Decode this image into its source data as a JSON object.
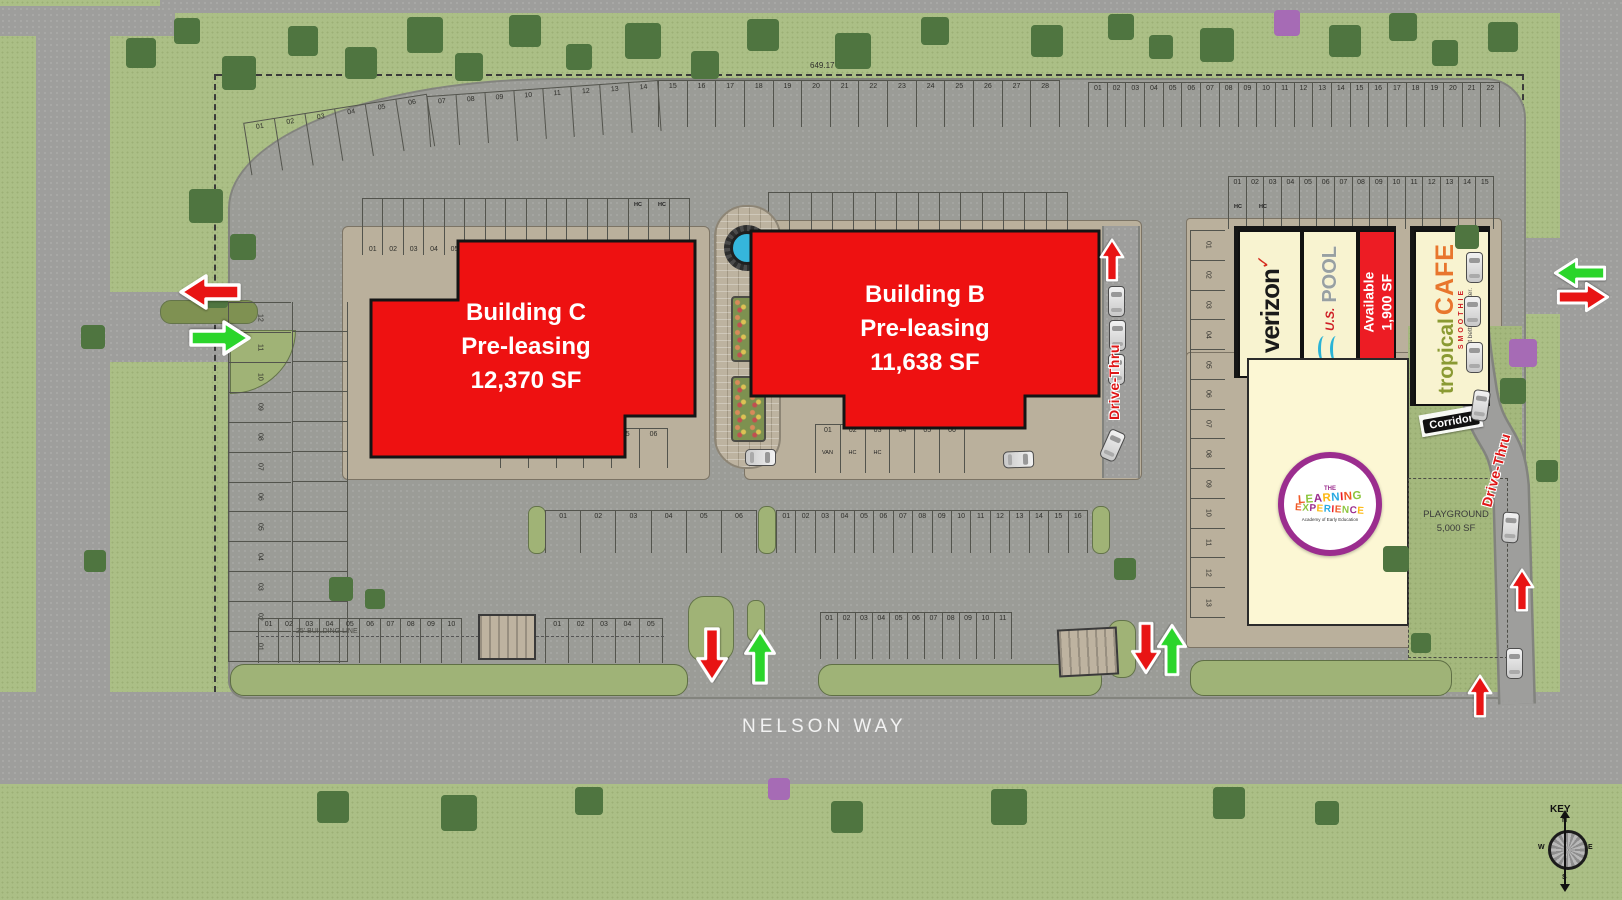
{
  "site": {
    "street_name": "NELSON WAY",
    "boundary_length": "649.17'",
    "boundary_bearing": "N 89°26'09\" E",
    "building_line": "25' BUILDING LINE",
    "key_label": "KEY",
    "compass": {
      "n": "N",
      "e": "E",
      "s": "S",
      "w": "W"
    }
  },
  "buildings": {
    "c": {
      "name": "Building C",
      "status": "Pre-leasing",
      "area": "12,370 SF"
    },
    "b": {
      "name": "Building B",
      "status": "Pre-leasing",
      "area": "11,638 SF"
    },
    "available": {
      "label": "Available",
      "area": "1,900 SF"
    }
  },
  "tenants": {
    "verizon": {
      "name": "verizon",
      "mark": "✓"
    },
    "us_pool": {
      "prefix": "U.S.",
      "name": "POOL"
    },
    "tropical": {
      "main": "tropical",
      "sub": "SMOOTHIE",
      "cafe": "CAFE",
      "tagline": "eat better. feel better."
    },
    "learning": {
      "the": "THE",
      "word1": "LEARNING",
      "word2": "EXPERIENCE",
      "tagline": "Academy of Early Education"
    }
  },
  "labels": {
    "drive_thru": "Drive-Thru",
    "corridor": "Corridor",
    "playground": "PLAYGROUND",
    "playground_area": "5,000 SF",
    "hc": "HC",
    "van": "VAN"
  },
  "parking": {
    "top_row_a": [
      "01",
      "02",
      "03",
      "04",
      "05",
      "06"
    ],
    "top_row_b": [
      "07",
      "08",
      "09",
      "10",
      "11",
      "12",
      "13",
      "14"
    ],
    "top_row_c": [
      "15",
      "16",
      "17",
      "18",
      "19",
      "20",
      "21",
      "22",
      "23",
      "24",
      "25",
      "26",
      "27",
      "28"
    ],
    "top_right_row": [
      "01",
      "02",
      "03",
      "04",
      "05",
      "06",
      "07",
      "08",
      "09",
      "10",
      "11",
      "12",
      "13",
      "14",
      "15",
      "16",
      "17",
      "18",
      "19",
      "20",
      "21",
      "22"
    ],
    "row_above_c": [
      "01",
      "02",
      "03",
      "04",
      "05",
      "06",
      "07",
      "08",
      "09",
      "10",
      "11",
      "12",
      "13",
      "14",
      "15",
      "16"
    ],
    "row_above_b": [
      "01",
      "02",
      "03",
      "04",
      "05",
      "06",
      "07",
      "08",
      "09",
      "10",
      "11",
      "12",
      "13",
      "14"
    ],
    "strip_front": [
      "01",
      "02",
      "03",
      "04",
      "05",
      "06",
      "07",
      "08",
      "09",
      "10",
      "11",
      "12",
      "13",
      "14",
      "15"
    ],
    "left_column": [
      "12",
      "11",
      "10",
      "09",
      "08",
      "07",
      "06",
      "05",
      "04",
      "03",
      "02",
      "01"
    ],
    "strip_side": [
      "01",
      "02",
      "03",
      "04",
      "05",
      "06",
      "07",
      "08",
      "09",
      "10",
      "11",
      "12",
      "13"
    ],
    "front_c": [
      "01",
      "02",
      "03",
      "04",
      "05",
      "06"
    ],
    "front_b": [
      "01",
      "02",
      "03",
      "04",
      "05",
      "06"
    ],
    "front_b_sub": [
      "VAN",
      "HC",
      "HC",
      "",
      "",
      ""
    ],
    "center_west": [
      "01",
      "02",
      "03",
      "04",
      "05",
      "06"
    ],
    "center_east": [
      "01",
      "02",
      "03",
      "04",
      "05",
      "06",
      "07",
      "08",
      "09",
      "10",
      "11",
      "12",
      "13",
      "14",
      "15",
      "16"
    ],
    "bottom_a": [
      "01",
      "02",
      "03",
      "04",
      "05",
      "06",
      "07",
      "08",
      "09",
      "10"
    ],
    "bottom_b": [
      "01",
      "02",
      "03",
      "04",
      "05"
    ],
    "bottom_c": [
      "01",
      "02",
      "03",
      "04",
      "05",
      "06",
      "07",
      "08",
      "09",
      "10",
      "11"
    ]
  },
  "colors": {
    "grass": "#abbf86",
    "road": "#9e9e9c",
    "lot": "#9b9c97",
    "building_red": "#ee1111",
    "pad_tan": "#bab09c",
    "panel_cream": "#f8f3d0",
    "available_red": "#ed1c24",
    "verizon_black": "#1a1a1a",
    "verizon_check_red": "#d52b1e",
    "pool_blue": "#2ab3d6",
    "pool_red": "#cf2027",
    "tropical_green": "#8a9a33",
    "tropical_orange": "#e8762d",
    "logo_purple": "#9b2d8e",
    "arrow_green": "#2bd52b",
    "arrow_red": "#e81414",
    "drive_thru_red": "#df1616",
    "logo_palette": [
      "#f05a28",
      "#8dc63f",
      "#9b2d8e",
      "#fdb913",
      "#29abe2",
      "#ed1c24"
    ]
  }
}
